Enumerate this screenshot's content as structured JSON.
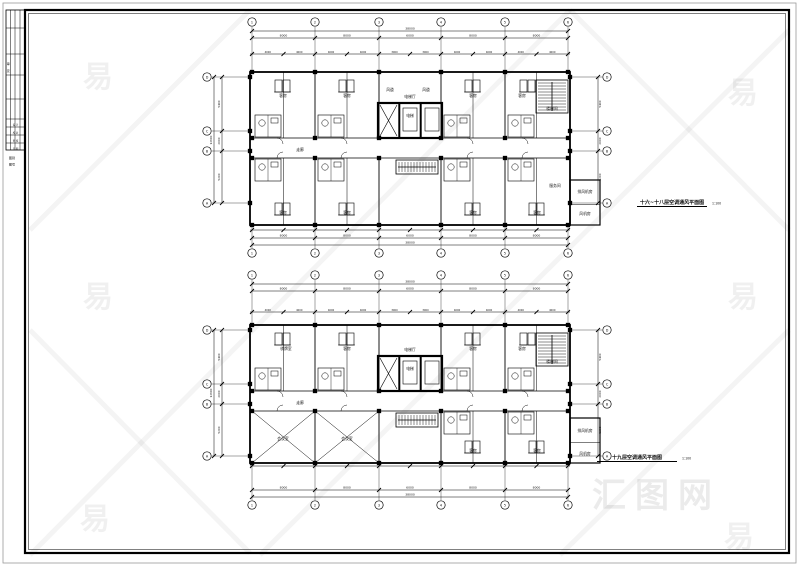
{
  "watermark": {
    "glyph": "易",
    "logo_text": "汇图网"
  },
  "titleblock": {
    "side_labels": [
      "审",
      "定"
    ],
    "row_labels": [
      "设 计",
      "校 对",
      "审 核",
      "日 期"
    ],
    "footer_labels": [
      "图别",
      "图号"
    ]
  },
  "plans": [
    {
      "title": "十六~十八层空调通风平面图",
      "scale": "1:100",
      "grid_cols": [
        "1",
        "2",
        "3",
        "4",
        "5",
        "6"
      ],
      "grid_rows": [
        "D",
        "C",
        "B",
        "A"
      ],
      "dims_top_overall": "38000",
      "dims_top": [
        "8000",
        "8000",
        "6000",
        "8000",
        "8000"
      ],
      "dims_detail": [
        "4000",
        "4000",
        "4000",
        "4000",
        "3000",
        "3000",
        "4000",
        "4000",
        "4000",
        "4000"
      ],
      "dims_left": [
        "5400",
        "2000",
        "5200"
      ],
      "dims_left_overall": "12600",
      "dims_right": [
        "5400",
        "2000",
        "5200"
      ],
      "dims_bottom": [
        "8000",
        "8000",
        "6000",
        "8000",
        "8000"
      ],
      "dims_bottom_overall": "38000",
      "rooms": [
        {
          "t": "客房",
          "x": 283,
          "y": 97
        },
        {
          "t": "客房",
          "x": 347,
          "y": 97
        },
        {
          "t": "电梯厅",
          "x": 410,
          "y": 98
        },
        {
          "t": "客房",
          "x": 473,
          "y": 97
        },
        {
          "t": "客房",
          "x": 522,
          "y": 97
        },
        {
          "t": "楼梯间",
          "x": 552,
          "y": 110
        },
        {
          "t": "风道",
          "x": 390,
          "y": 91
        },
        {
          "t": "风道",
          "x": 426,
          "y": 91
        },
        {
          "t": "电梯",
          "x": 410,
          "y": 117
        },
        {
          "t": "走廊",
          "x": 300,
          "y": 151
        },
        {
          "t": "客房",
          "x": 283,
          "y": 214
        },
        {
          "t": "客房",
          "x": 347,
          "y": 214
        },
        {
          "t": "客房",
          "x": 473,
          "y": 214
        },
        {
          "t": "客房",
          "x": 537,
          "y": 214
        },
        {
          "t": "服务间",
          "x": 555,
          "y": 187
        },
        {
          "t": "排风机房",
          "x": 585,
          "y": 193
        },
        {
          "t": "风机房",
          "x": 585,
          "y": 215
        }
      ]
    },
    {
      "title": "十九层空调通风平面图",
      "scale": "1:100",
      "grid_cols": [
        "1",
        "2",
        "3",
        "4",
        "5",
        "6"
      ],
      "grid_rows": [
        "D",
        "C",
        "B",
        "A"
      ],
      "dims_top_overall": "38000",
      "dims_top": [
        "8000",
        "8000",
        "6000",
        "8000",
        "8000"
      ],
      "dims_detail": [
        "4000",
        "4000",
        "4000",
        "4000",
        "3000",
        "3000",
        "4000",
        "4000",
        "4000",
        "4000"
      ],
      "dims_left": [
        "5400",
        "2000",
        "5200"
      ],
      "dims_left_overall": "12600",
      "dims_right": [
        "5400",
        "2000",
        "5200"
      ],
      "dims_bottom": [
        "8000",
        "8000",
        "6000",
        "8000",
        "8000"
      ],
      "dims_bottom_overall": "38000",
      "rooms": [
        {
          "t": "棋牌室",
          "x": 286,
          "y": 350
        },
        {
          "t": "客房",
          "x": 347,
          "y": 350
        },
        {
          "t": "电梯厅",
          "x": 410,
          "y": 351
        },
        {
          "t": "客房",
          "x": 473,
          "y": 350
        },
        {
          "t": "客房",
          "x": 522,
          "y": 350
        },
        {
          "t": "楼梯间",
          "x": 552,
          "y": 363
        },
        {
          "t": "电梯",
          "x": 410,
          "y": 370
        },
        {
          "t": "走廊",
          "x": 300,
          "y": 404
        },
        {
          "t": "会议室",
          "x": 283,
          "y": 440
        },
        {
          "t": "会议室",
          "x": 347,
          "y": 440
        },
        {
          "t": "客房",
          "x": 473,
          "y": 452
        },
        {
          "t": "客房",
          "x": 537,
          "y": 452
        },
        {
          "t": "排风机房",
          "x": 585,
          "y": 432
        },
        {
          "t": "风机房",
          "x": 585,
          "y": 455
        }
      ]
    }
  ]
}
